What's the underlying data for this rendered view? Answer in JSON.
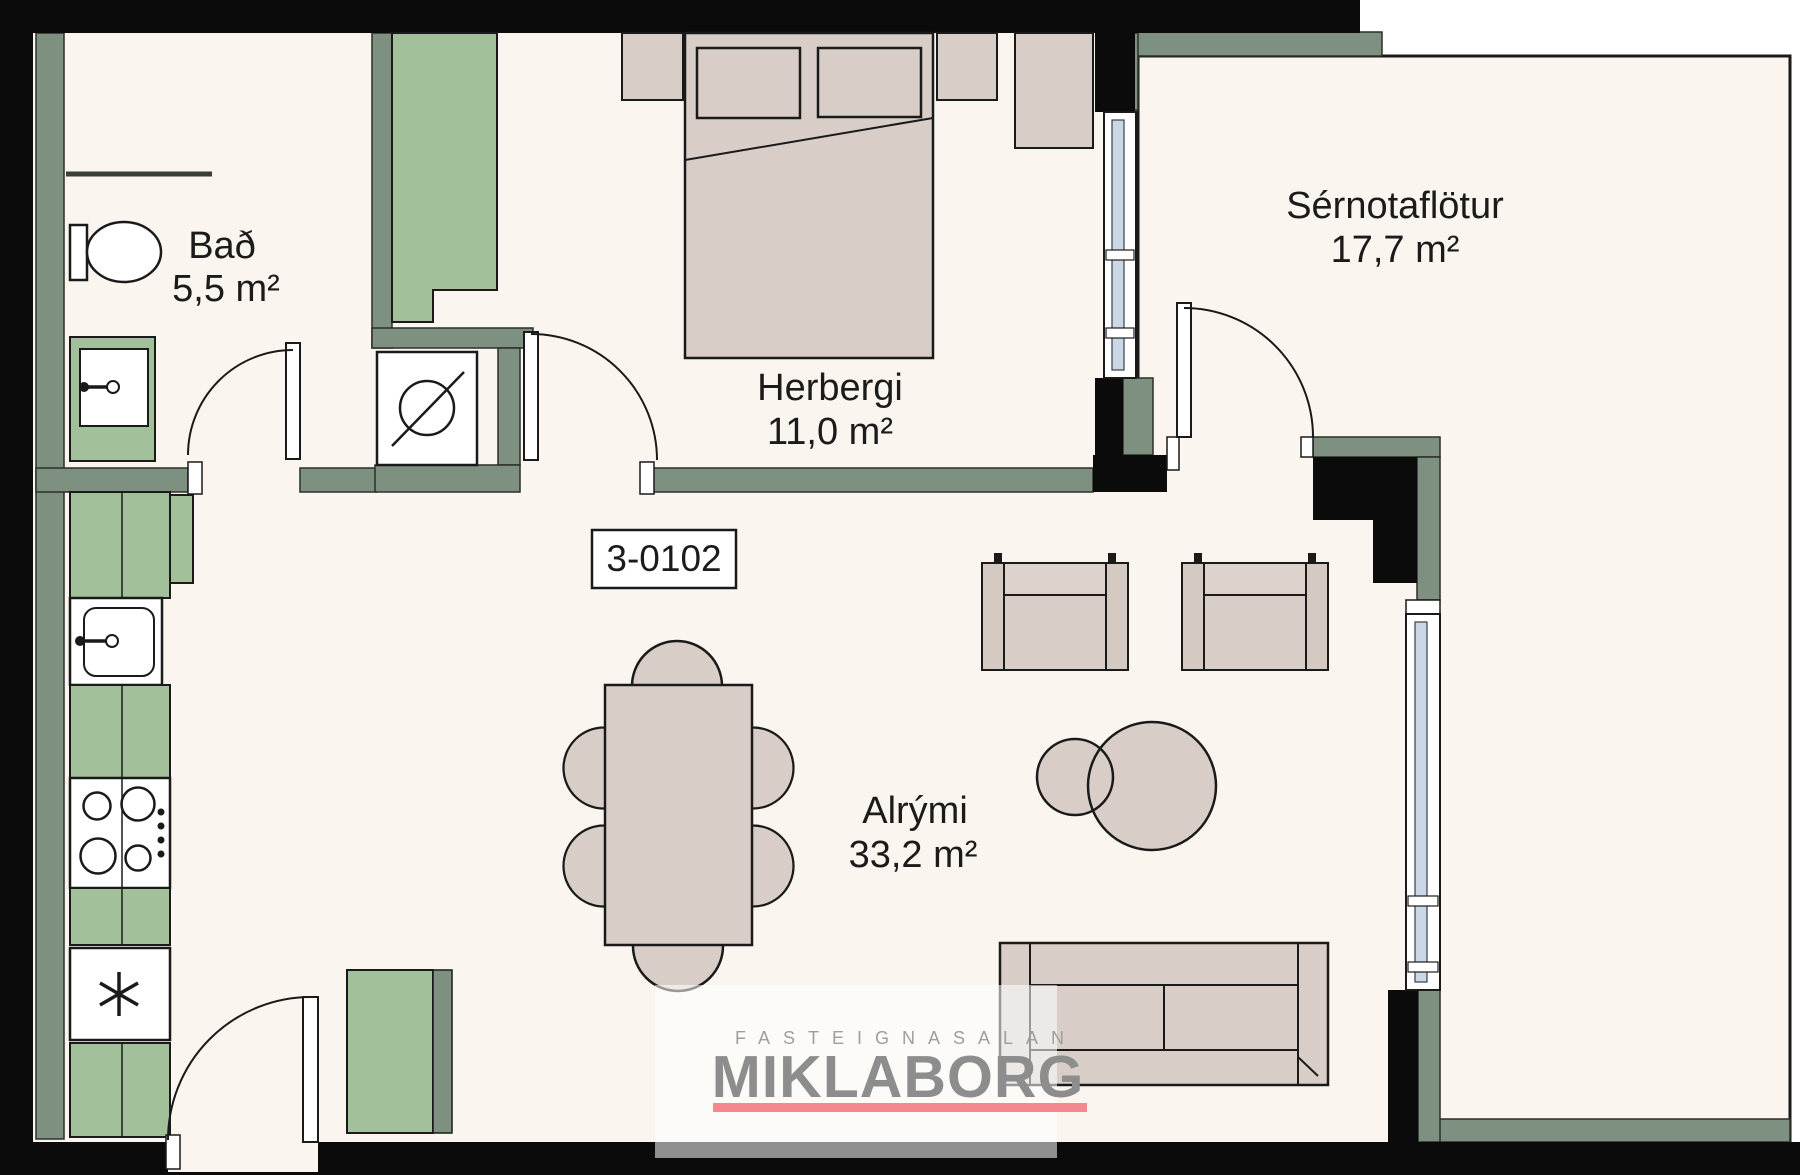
{
  "unit_label": "3-0102",
  "rooms": {
    "bathroom": {
      "name": "Bað",
      "area": "5,5 m²"
    },
    "bedroom": {
      "name": "Herbergi",
      "area": "11,0 m²"
    },
    "private_area": {
      "name": "Sérnotaflötur",
      "area": "17,7 m²"
    },
    "living_area": {
      "name": "Alrými",
      "area": "33,2 m²"
    }
  },
  "watermark": {
    "agency_tagline": "FASTEIGNASALAN",
    "brand": "MIKLABORG",
    "underline_color": "#F5878F",
    "brand_color": "#8D8D8D",
    "tagline_color": "#9E9E9E"
  },
  "colors": {
    "wall": "#0B0B0C",
    "wall_lining": "#7E9181",
    "cabinet_green": "#A2C19B",
    "furniture_beige": "#D8CEC7",
    "floor": "#FAF5EF",
    "glass": "#C9D7E7"
  }
}
